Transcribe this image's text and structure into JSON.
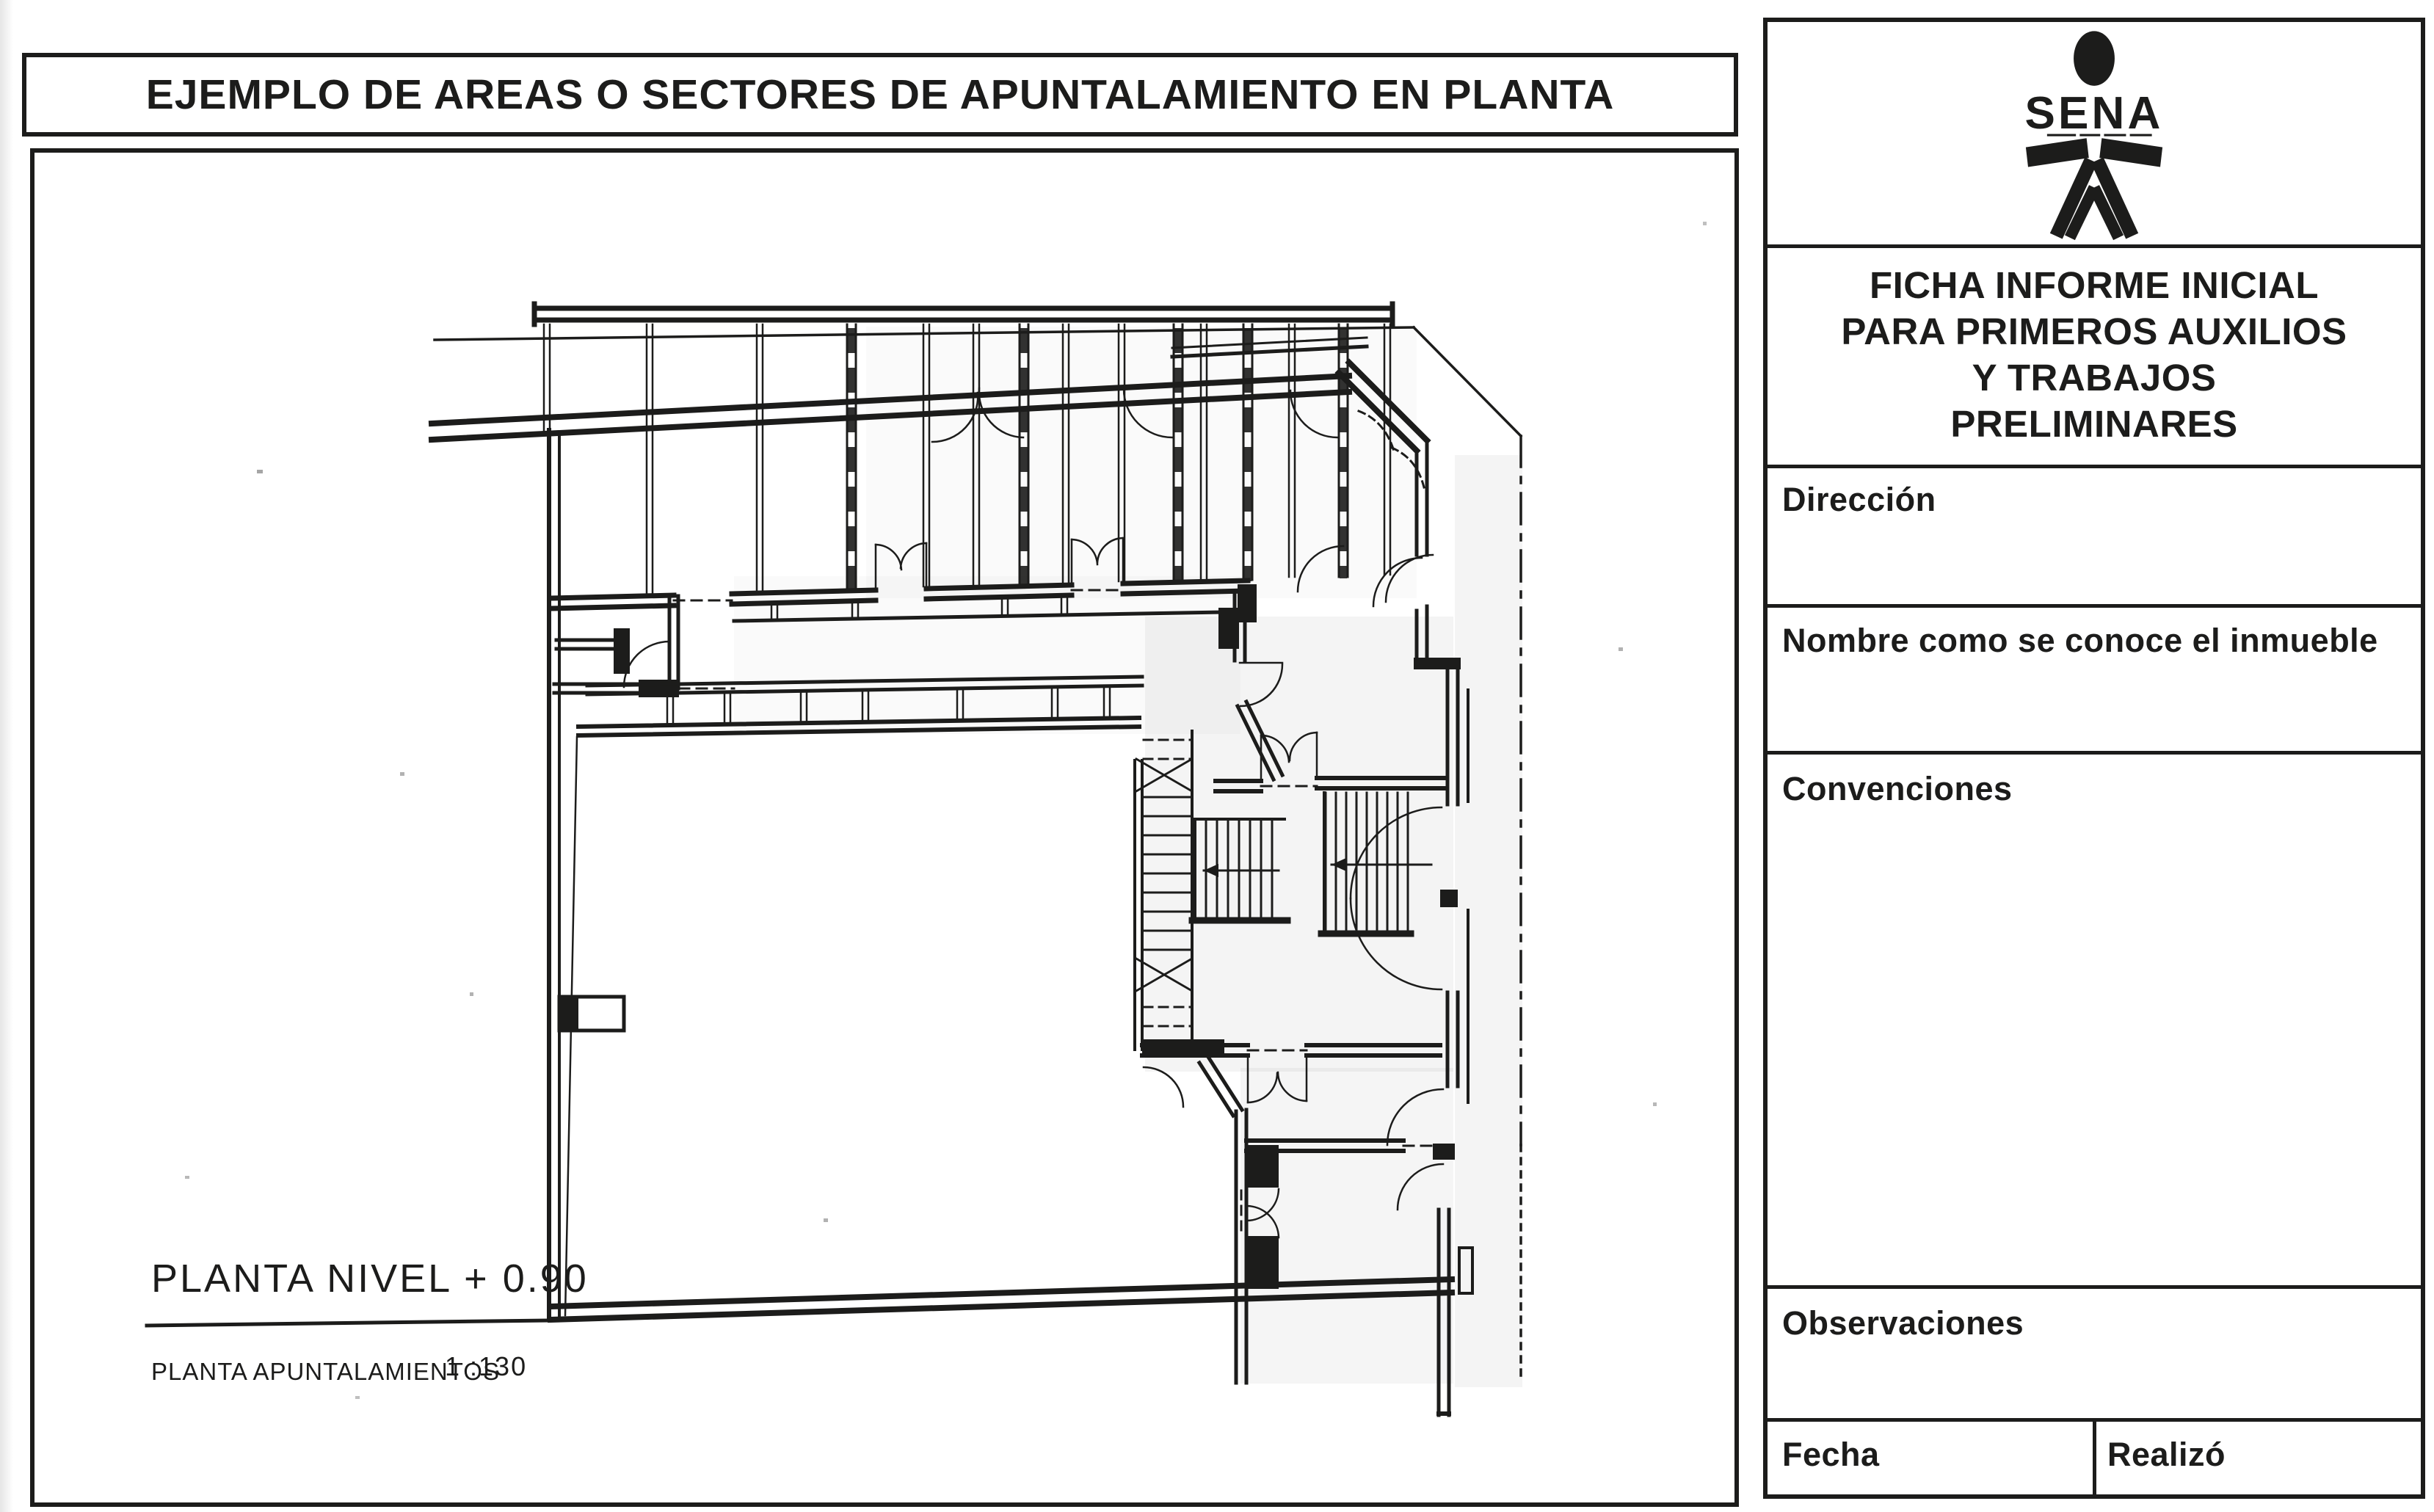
{
  "colors": {
    "ink": "#1c1c1b",
    "paper": "#ffffff"
  },
  "header": {
    "title": "EJEMPLO DE AREAS O SECTORES DE APUNTALAMIENTO EN PLANTA"
  },
  "plan": {
    "level_label": "PLANTA NIVEL + 0.90",
    "caption": "PLANTA APUNTALAMIENTOS",
    "scale_label": "1 :130"
  },
  "sidebar": {
    "logo": {
      "text": "SENA",
      "icon": "sena-person-icon"
    },
    "form_title": {
      "line1": "FICHA INFORME INICIAL",
      "line2": "PARA PRIMEROS AUXILIOS",
      "line3": "Y TRABAJOS",
      "line4": "PRELIMINARES"
    },
    "fields": {
      "direccion": "Dirección",
      "nombre": "Nombre como se conoce el inmueble",
      "convenciones": "Convenciones",
      "observaciones": "Observaciones",
      "fecha": "Fecha",
      "realizo": "Realizó"
    }
  }
}
